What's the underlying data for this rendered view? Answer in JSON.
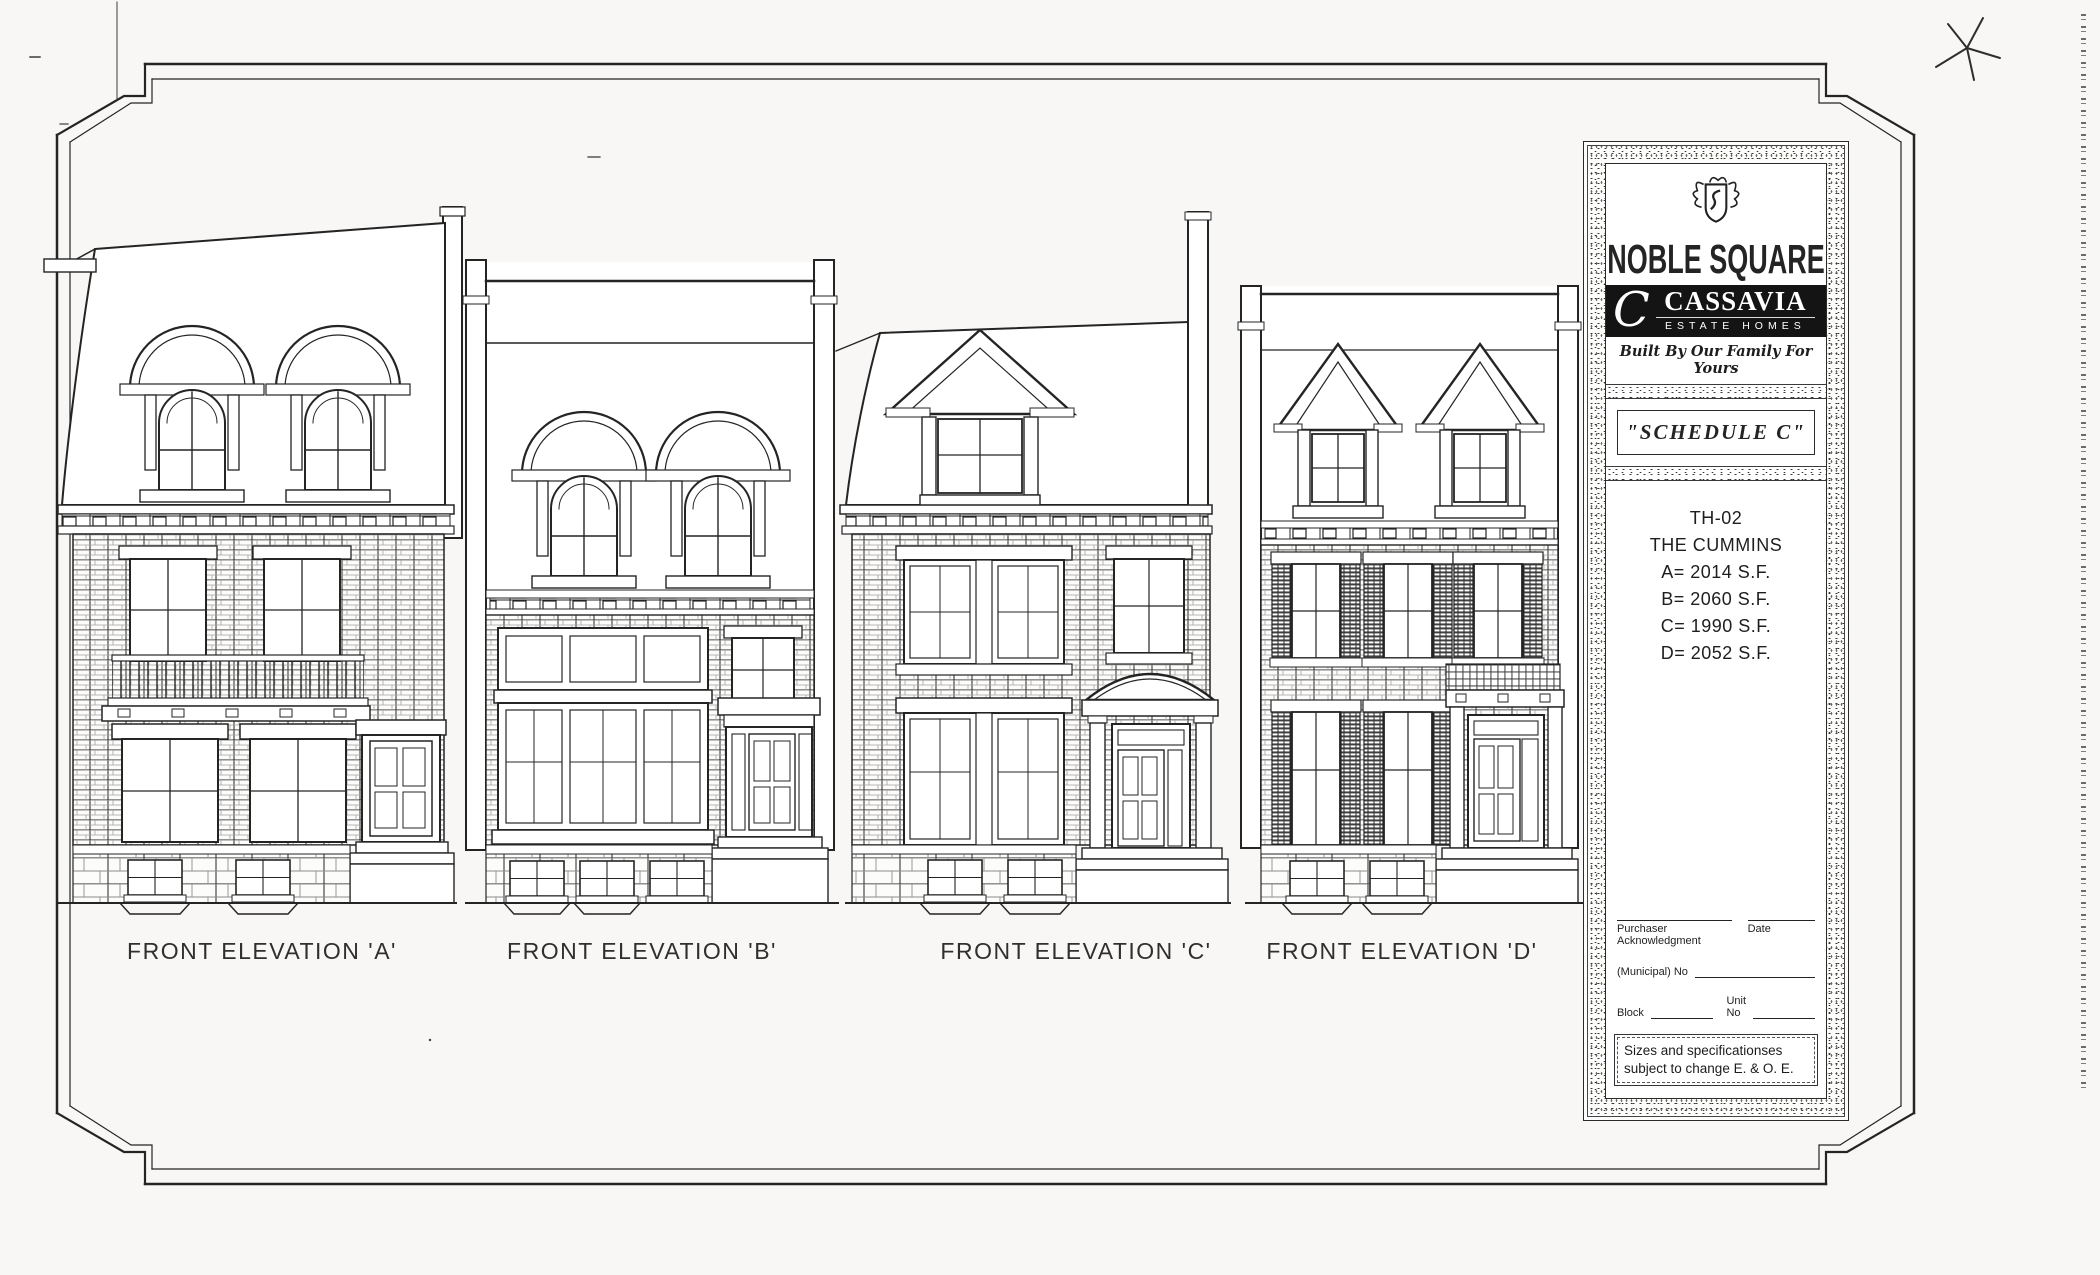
{
  "colors": {
    "ink": "#242424",
    "paper": "#f8f7f5",
    "logo_band": "#141414"
  },
  "sheet": {
    "elevations": [
      {
        "label": "FRONT ELEVATION 'A'"
      },
      {
        "label": "FRONT ELEVATION 'B'"
      },
      {
        "label": "FRONT ELEVATION 'C'"
      },
      {
        "label": "FRONT ELEVATION 'D'"
      }
    ]
  },
  "title_block": {
    "community": "NOBLE SQUARE",
    "builder": {
      "initial": "C",
      "name": "CASSAVIA",
      "subtitle": "ESTATE HOMES",
      "tagline": "Built By Our Family For Yours"
    },
    "schedule_title": "\"SCHEDULE  C\"",
    "model": {
      "code": "TH-02",
      "name": "THE CUMMINS",
      "areas": [
        "A= 2014 S.F.",
        "B= 2060 S.F.",
        "C= 1990 S.F.",
        "D= 2052 S.F."
      ]
    },
    "form": {
      "purchaser_label": "Purchaser Acknowledgment",
      "date_label": "Date",
      "municipal_label": "(Municipal) No",
      "block_label": "Block",
      "unit_label": "Unit No"
    },
    "note": "Sizes and specificationses subject to change E. & O. E."
  }
}
